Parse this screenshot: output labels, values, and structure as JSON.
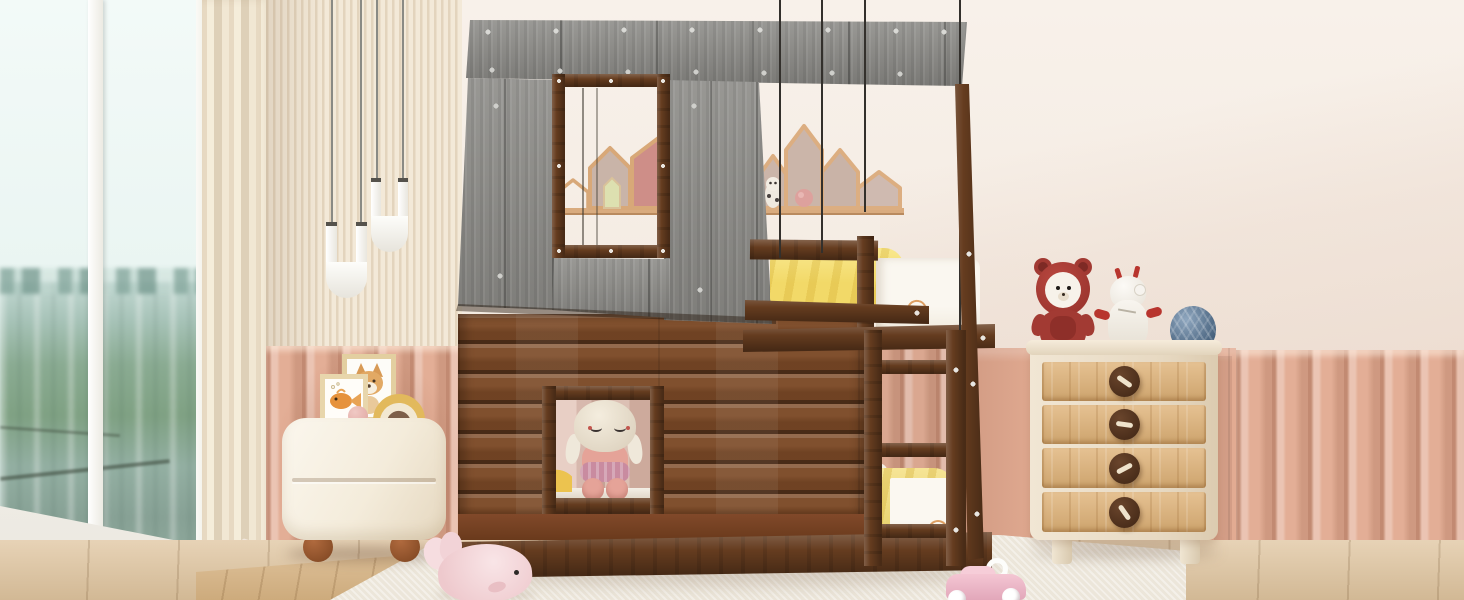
{
  "meta": {
    "title": "Kids bedroom with house-shaped wooden bunk bed, gray roof and yellow bedding"
  },
  "palette": {
    "wallCream": "#f5ece3",
    "slatLight": "#f3e9d8",
    "slatDark": "#e3d4bd",
    "curtainBeige": "#eee3cf",
    "pinkPanel": "#e2ab92",
    "pinkLight": "#f2c7b0",
    "pinkDark": "#c98e74",
    "roofGray": "#908f8b",
    "walnut": "#653c1f",
    "walnutLight": "#7d4e29",
    "walnutDark": "#46280f",
    "logBrown": "#7c4a27",
    "oakDrawer": "#dfb277",
    "creamFurniture": "#f3ecdd",
    "yellowBedding": "#f2d968",
    "mattressWhite": "#f7f3ec",
    "skyWindow": "#eef7f5",
    "cityTeal": "#9fc0b4",
    "treeGreen": "#7fa183",
    "floorWood": "#dfc49e",
    "floorWoodWarm": "#d8b483",
    "rug": "#ece6da",
    "plushPink": "#f3d3d8",
    "toyCarPink": "#eebccb",
    "yarnBlue": "#53779c",
    "bearRed": "#a23a33",
    "shelfWood": "#dcae81",
    "shelfHousePink": "#ce8e88",
    "shelfHouseTaupe": "#cbb5a9",
    "dollCream": "#ece3d3",
    "dollPink": "#e5a398",
    "stringBlack": "#33302c"
  },
  "scene": {
    "room": {
      "window_view": "city skyline with trees",
      "left_wall": "vertical wood slat panel",
      "wainscot": "salmon fluted panels",
      "floor": "light oak with cream rug"
    },
    "pendant_lamps": {
      "count": 2,
      "shape": "white U tubes"
    },
    "wall_shelves": {
      "left_group_houses": 3,
      "right_group_houses": 4,
      "contents": [
        "mini green house",
        "tiny doll",
        "pink ball"
      ]
    },
    "bunk_bed": {
      "type": "house bunk bed",
      "roof": "gray weathered wood with plank rivets",
      "frame": "walnut brown",
      "front": "log cabin wall",
      "roof_window": "open brown frame",
      "cabin_window_toy": "plush doll with closed eyes and pink tutu",
      "bedding": "yellow comforters with white rainbow-print mattresses",
      "ladder_rungs": 3
    },
    "nightstand": {
      "drawers": 2,
      "items": [
        "fox art frame",
        "goldfish art frame",
        "pink ball",
        "rainbow ornament"
      ]
    },
    "dresser": {
      "drawers": 4,
      "knobs": "round dark wood with toggle sticks",
      "toys": [
        "red hooded bear plush",
        "white robot figure with red hands",
        "blue yarn ball"
      ]
    },
    "floor_toys": [
      "pink whale plush",
      "pink toy car with white wheels"
    ]
  }
}
